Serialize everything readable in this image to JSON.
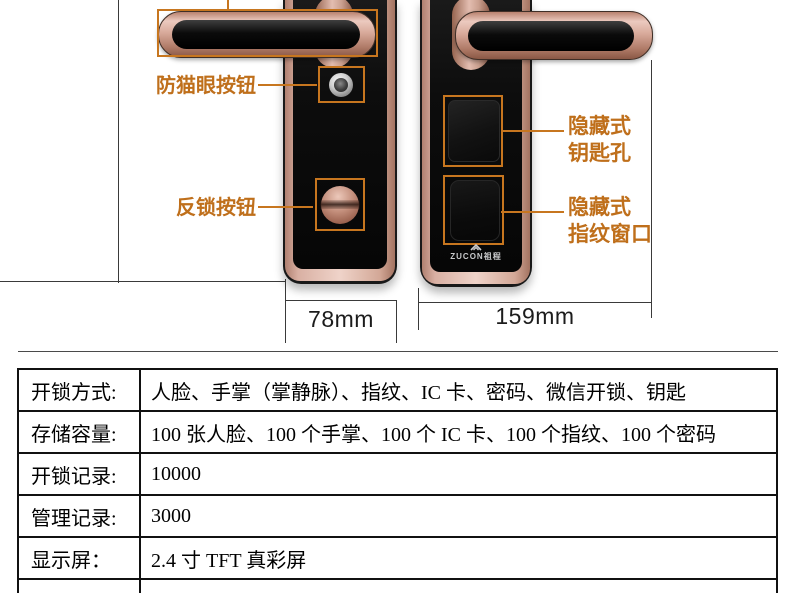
{
  "colors": {
    "accent_orange": "#c7761f",
    "rose_gold": "#d4a294",
    "table_border": "#111111",
    "background": "#ffffff"
  },
  "front_view": {
    "callouts": [
      {
        "label": "防猫眼按钮"
      },
      {
        "label": "反锁按钮"
      }
    ],
    "width_dimension": "78mm"
  },
  "side_view": {
    "callouts": [
      {
        "line1": "隐藏式",
        "line2": "钥匙孔"
      },
      {
        "line1": "隐藏式",
        "line2": "指纹窗口"
      }
    ],
    "width_dimension": "159mm",
    "brand_logo": "ZUCON祖程"
  },
  "spec_table": {
    "rows": [
      {
        "label": "开锁方式:",
        "value": "人脸、手掌（掌静脉）、指纹、IC 卡、密码、微信开锁、钥匙"
      },
      {
        "label": "存储容量:",
        "value": "100 张人脸、100 个手掌、100 个 IC 卡、100 个指纹、100 个密码"
      },
      {
        "label": "开锁记录:",
        "value": "10000"
      },
      {
        "label": "管理记录:",
        "value": "3000"
      },
      {
        "label": "显示屏：",
        "value": "2.4 寸 TFT 真彩屏"
      }
    ]
  }
}
